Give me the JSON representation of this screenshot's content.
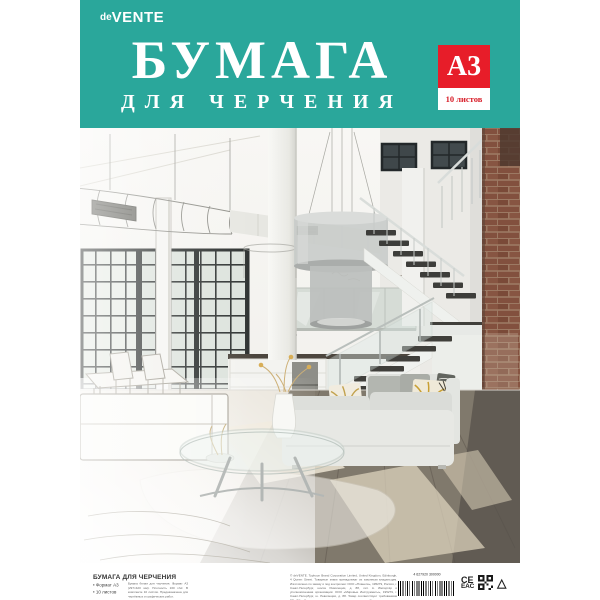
{
  "brand": {
    "prefix": "de",
    "name": "VENTE"
  },
  "header": {
    "title": "БУМАГА",
    "subtitle": "ДЛЯ ЧЕРЧЕНИЯ",
    "bg_color": "#2aa79b"
  },
  "badge": {
    "format": "А3",
    "sheets": "10 листов",
    "bg_color": "#e71d29"
  },
  "footer": {
    "product_title": "БУМАГА ДЛЯ ЧЕРЧЕНИЯ",
    "bullets": [
      "Формат А3",
      "10 листов"
    ],
    "details": "Бумага белая для черчения. Формат А3 (297×420 мм). Плотность 160 г/м². В комплекте 10 листов. Предназначена для чертёжных и графических работ.",
    "legal": "© deVENTE. Typhoon Brand Corporation Limited, United Kingdom, Edinburgh, 4 Queen Street. Товарные знаки принадлежат их законным владельцам. Изготовлено по заказу и под контролем: ООО «Планета», 195279, Россия, г. Санкт-Петербург, шоссе Революции, д. 88, лит. А. Импортёр и уполномоченная организация: ООО «Мировые Инструменты», 195279, г. Санкт-Петербург, ш. Революции, д. 88. Товар соответствует требованиям ТР ТС. Дата изготовления указана на упаковке. Срок годности не ограничен. Хранить в сухом месте. Сделано в Китае. www.devente.ru. Арт. 2030801.",
    "barcode_number": "4 627920 300000",
    "marks": {
      "ce": "CE",
      "eac": "EAC",
      "triangle": "△"
    }
  }
}
